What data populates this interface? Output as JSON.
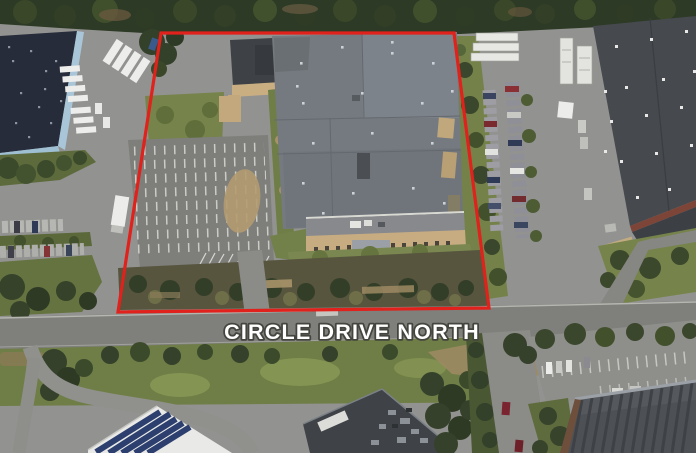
{
  "scene": {
    "type": "aerial-satellite-view",
    "road_label": "CIRCLE DRIVE NORTH"
  },
  "annotation": {
    "boundary_color": "#e0211c",
    "label_fill": "#ffffff"
  }
}
